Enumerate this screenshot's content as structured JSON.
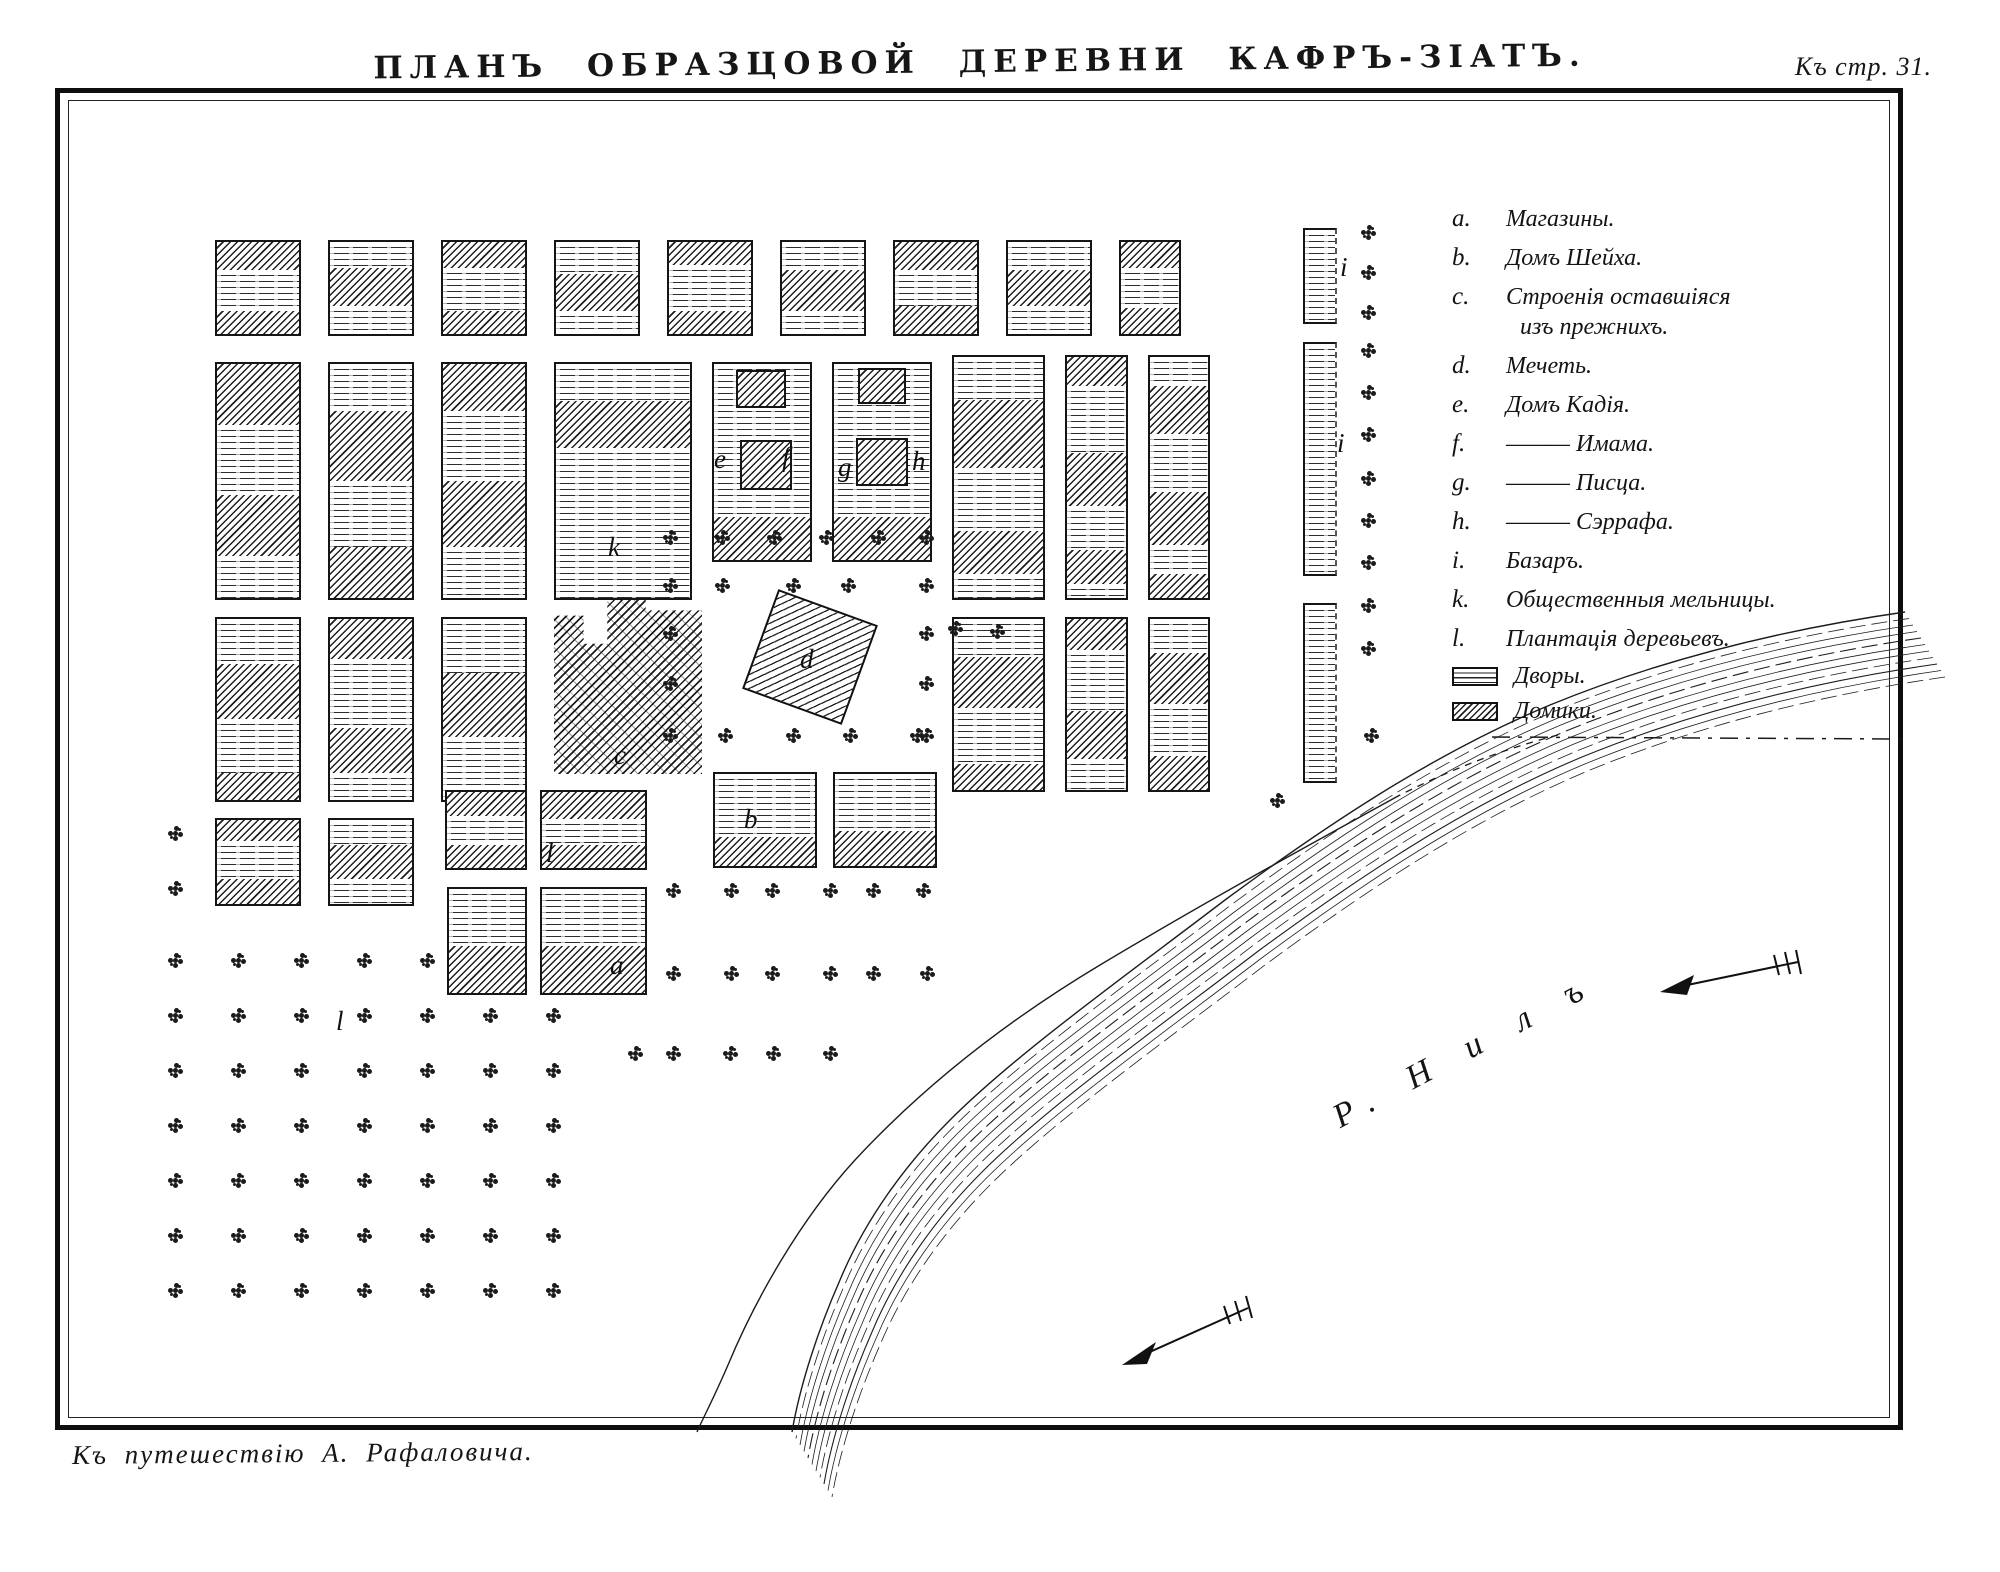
{
  "page": {
    "title": "ПЛАНЪ ОБРАЗЦОВОЙ ДЕРЕВНИ КАФРЪ-ЗІАТЪ.",
    "page_ref": "Къ стр. 31.",
    "caption": "Къ путешествію А. Рафаловича."
  },
  "colors": {
    "ink": "#161616",
    "paper": "#ffffff"
  },
  "legend": {
    "items": [
      {
        "letter": "a.",
        "lines": [
          "Магазины."
        ]
      },
      {
        "letter": "b.",
        "lines": [
          "Домъ Шейха."
        ]
      },
      {
        "letter": "c.",
        "lines": [
          "Строенія оставшіяся",
          "изъ прежнихъ."
        ]
      },
      {
        "letter": "d.",
        "lines": [
          "Мечеть."
        ]
      },
      {
        "letter": "e.",
        "lines": [
          "Домъ Кадія."
        ]
      },
      {
        "letter": "f.",
        "lines": [
          "——— Имама."
        ]
      },
      {
        "letter": "g.",
        "lines": [
          "——— Писца."
        ]
      },
      {
        "letter": "h.",
        "lines": [
          "——— Сэррафа."
        ]
      },
      {
        "letter": "i.",
        "lines": [
          "Базаръ."
        ]
      },
      {
        "letter": "k.",
        "lines": [
          "Общественныя мельницы."
        ]
      },
      {
        "letter": "l.",
        "lines": [
          "Плантація деревьевъ."
        ]
      }
    ],
    "swatches": [
      {
        "pattern": "yard",
        "label": "Дворы."
      },
      {
        "pattern": "house",
        "label": "Домики."
      }
    ]
  },
  "map": {
    "river_label": "Р. Н и л ъ",
    "letters": [
      {
        "t": "k",
        "x": 608,
        "y": 532
      },
      {
        "t": "e",
        "x": 714,
        "y": 444
      },
      {
        "t": "f",
        "x": 782,
        "y": 442
      },
      {
        "t": "g",
        "x": 838,
        "y": 452
      },
      {
        "t": "h",
        "x": 912,
        "y": 446
      },
      {
        "t": "d",
        "x": 800,
        "y": 644
      },
      {
        "t": "c",
        "x": 614,
        "y": 740
      },
      {
        "t": "b",
        "x": 744,
        "y": 804
      },
      {
        "t": "a",
        "x": 610,
        "y": 950
      },
      {
        "t": "i",
        "x": 1340,
        "y": 252
      },
      {
        "t": "i",
        "x": 1337,
        "y": 428
      },
      {
        "t": "l",
        "x": 546,
        "y": 838
      },
      {
        "t": "l",
        "x": 336,
        "y": 1006
      }
    ],
    "mosque": {
      "x": 757,
      "y": 604,
      "w": 106,
      "h": 106,
      "rot": 20
    },
    "old_building": {
      "x": 554,
      "y": 598,
      "w": 148,
      "h": 176
    },
    "blocks": [
      {
        "x": 215,
        "y": 240,
        "w": 86,
        "h": 96,
        "p": "h30 y45 h25"
      },
      {
        "x": 328,
        "y": 240,
        "w": 86,
        "h": 96,
        "p": "y28 h42 y30"
      },
      {
        "x": 441,
        "y": 240,
        "w": 86,
        "h": 96,
        "p": "h28 y47 h25"
      },
      {
        "x": 554,
        "y": 240,
        "w": 86,
        "h": 96,
        "p": "y35 h40 y25"
      },
      {
        "x": 667,
        "y": 240,
        "w": 86,
        "h": 96,
        "p": "h25 y50 h25"
      },
      {
        "x": 780,
        "y": 240,
        "w": 86,
        "h": 96,
        "p": "y30 h45 y25"
      },
      {
        "x": 893,
        "y": 240,
        "w": 86,
        "h": 96,
        "p": "h30 y40 h30"
      },
      {
        "x": 1006,
        "y": 240,
        "w": 86,
        "h": 96,
        "p": "y30 h40 y30"
      },
      {
        "x": 1119,
        "y": 240,
        "w": 62,
        "h": 96,
        "p": "h28 y44 h28"
      },
      {
        "x": 215,
        "y": 362,
        "w": 86,
        "h": 238,
        "p": "h26 y30 h26 y18"
      },
      {
        "x": 328,
        "y": 362,
        "w": 86,
        "h": 238,
        "p": "y20 h30 y28 h22"
      },
      {
        "x": 441,
        "y": 362,
        "w": 86,
        "h": 238,
        "p": "h20 y30 h28 y22"
      },
      {
        "x": 554,
        "y": 362,
        "w": 138,
        "h": 238,
        "p": "y16 h20 y64"
      },
      {
        "x": 712,
        "y": 362,
        "w": 100,
        "h": 200,
        "p": "y78 h22"
      },
      {
        "x": 736,
        "y": 370,
        "w": 50,
        "h": 38,
        "p": "h100"
      },
      {
        "x": 740,
        "y": 440,
        "w": 52,
        "h": 50,
        "p": "h100"
      },
      {
        "x": 832,
        "y": 362,
        "w": 100,
        "h": 200,
        "p": "y78 h22"
      },
      {
        "x": 858,
        "y": 368,
        "w": 48,
        "h": 36,
        "p": "h100"
      },
      {
        "x": 856,
        "y": 438,
        "w": 52,
        "h": 48,
        "p": "h100"
      },
      {
        "x": 952,
        "y": 355,
        "w": 93,
        "h": 245,
        "p": "y18 h28 y26 h18 y10"
      },
      {
        "x": 1065,
        "y": 355,
        "w": 63,
        "h": 245,
        "p": "h12 y28 h22 y18 h14 y6"
      },
      {
        "x": 1148,
        "y": 355,
        "w": 62,
        "h": 245,
        "p": "y12 h20 y24 h22 y12 h10"
      },
      {
        "x": 215,
        "y": 617,
        "w": 86,
        "h": 185,
        "p": "y25 h30 y30 h15"
      },
      {
        "x": 328,
        "y": 617,
        "w": 86,
        "h": 185,
        "p": "h22 y38 h25 y15"
      },
      {
        "x": 441,
        "y": 617,
        "w": 86,
        "h": 185,
        "p": "y30 h35 y35"
      },
      {
        "x": 952,
        "y": 617,
        "w": 93,
        "h": 175,
        "p": "y22 h30 y33 h15"
      },
      {
        "x": 1065,
        "y": 617,
        "w": 63,
        "h": 175,
        "p": "h18 y36 h28 y18"
      },
      {
        "x": 1148,
        "y": 617,
        "w": 62,
        "h": 175,
        "p": "y20 h30 y30 h20"
      },
      {
        "x": 713,
        "y": 772,
        "w": 104,
        "h": 96,
        "p": "y68 h32"
      },
      {
        "x": 833,
        "y": 772,
        "w": 104,
        "h": 96,
        "p": "y62 h38"
      },
      {
        "x": 215,
        "y": 818,
        "w": 86,
        "h": 88,
        "p": "h25 y45 h30"
      },
      {
        "x": 328,
        "y": 818,
        "w": 86,
        "h": 88,
        "p": "y30 h40 y30"
      },
      {
        "x": 445,
        "y": 790,
        "w": 82,
        "h": 80,
        "p": "h32 y38 h30"
      },
      {
        "x": 540,
        "y": 790,
        "w": 107,
        "h": 80,
        "p": "h35 y35 h30"
      },
      {
        "x": 447,
        "y": 887,
        "w": 80,
        "h": 108,
        "p": "y55 h45"
      },
      {
        "x": 540,
        "y": 887,
        "w": 107,
        "h": 108,
        "p": "y55 h45"
      },
      {
        "x": 1303,
        "y": 228,
        "w": 34,
        "h": 96,
        "p": "y100",
        "open": true
      },
      {
        "x": 1303,
        "y": 342,
        "w": 34,
        "h": 234,
        "p": "y100",
        "open": true
      },
      {
        "x": 1303,
        "y": 603,
        "w": 34,
        "h": 180,
        "p": "y100",
        "open": true
      }
    ],
    "trees": [
      [
        1368,
        232
      ],
      [
        1368,
        272
      ],
      [
        1368,
        312
      ],
      [
        1368,
        350
      ],
      [
        1368,
        392
      ],
      [
        1368,
        434
      ],
      [
        1368,
        478
      ],
      [
        1368,
        520
      ],
      [
        1368,
        562
      ],
      [
        1368,
        605
      ],
      [
        1368,
        648
      ],
      [
        1371,
        735
      ],
      [
        1277,
        800
      ],
      [
        670,
        537
      ],
      [
        722,
        537
      ],
      [
        774,
        537
      ],
      [
        826,
        537
      ],
      [
        878,
        537
      ],
      [
        926,
        537
      ],
      [
        670,
        585
      ],
      [
        670,
        633
      ],
      [
        670,
        683
      ],
      [
        670,
        735
      ],
      [
        926,
        585
      ],
      [
        926,
        633
      ],
      [
        926,
        683
      ],
      [
        926,
        735
      ],
      [
        722,
        585
      ],
      [
        793,
        585
      ],
      [
        848,
        585
      ],
      [
        725,
        735
      ],
      [
        793,
        735
      ],
      [
        850,
        735
      ],
      [
        917,
        735
      ],
      [
        673,
        890
      ],
      [
        731,
        890
      ],
      [
        772,
        890
      ],
      [
        830,
        890
      ],
      [
        873,
        890
      ],
      [
        923,
        890
      ],
      [
        673,
        973
      ],
      [
        731,
        973
      ],
      [
        772,
        973
      ],
      [
        830,
        973
      ],
      [
        873,
        973
      ],
      [
        927,
        973
      ],
      [
        635,
        1053
      ],
      [
        673,
        1053
      ],
      [
        730,
        1053
      ],
      [
        773,
        1053
      ],
      [
        830,
        1053
      ],
      [
        955,
        628
      ],
      [
        997,
        631
      ],
      [
        175,
        833
      ],
      [
        175,
        888
      ],
      [
        175,
        960
      ],
      [
        238,
        960
      ],
      [
        301,
        960
      ],
      [
        364,
        960
      ],
      [
        427,
        960
      ],
      [
        175,
        1015
      ],
      [
        238,
        1015
      ],
      [
        301,
        1015
      ],
      [
        364,
        1015
      ],
      [
        427,
        1015
      ],
      [
        490,
        1015
      ],
      [
        553,
        1015
      ],
      [
        175,
        1070
      ],
      [
        238,
        1070
      ],
      [
        301,
        1070
      ],
      [
        364,
        1070
      ],
      [
        427,
        1070
      ],
      [
        490,
        1070
      ],
      [
        553,
        1070
      ],
      [
        175,
        1125
      ],
      [
        238,
        1125
      ],
      [
        301,
        1125
      ],
      [
        364,
        1125
      ],
      [
        427,
        1125
      ],
      [
        490,
        1125
      ],
      [
        553,
        1125
      ],
      [
        175,
        1180
      ],
      [
        238,
        1180
      ],
      [
        301,
        1180
      ],
      [
        364,
        1180
      ],
      [
        427,
        1180
      ],
      [
        490,
        1180
      ],
      [
        553,
        1180
      ],
      [
        175,
        1235
      ],
      [
        238,
        1235
      ],
      [
        301,
        1235
      ],
      [
        364,
        1235
      ],
      [
        427,
        1235
      ],
      [
        490,
        1235
      ],
      [
        553,
        1235
      ],
      [
        175,
        1290
      ],
      [
        238,
        1290
      ],
      [
        301,
        1290
      ],
      [
        364,
        1290
      ],
      [
        427,
        1290
      ],
      [
        490,
        1290
      ],
      [
        553,
        1290
      ]
    ]
  }
}
